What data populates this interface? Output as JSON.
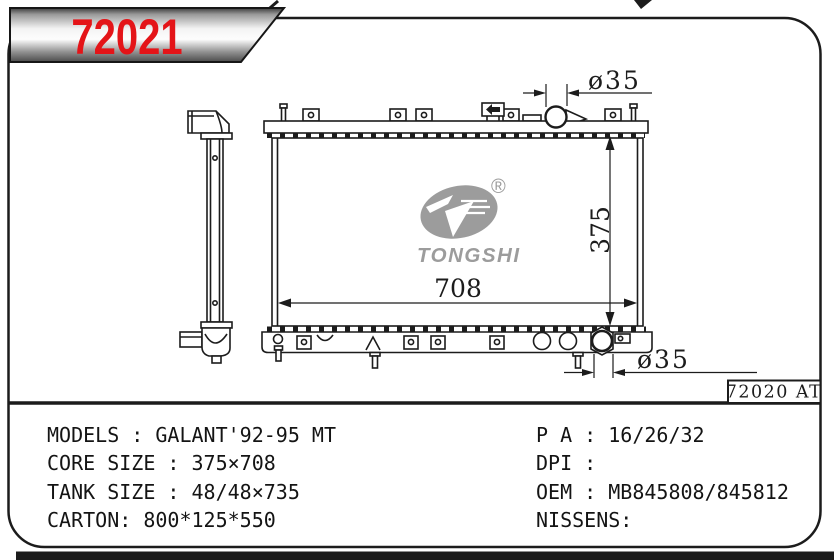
{
  "banner": {
    "part_number": "72021",
    "accent_color": "#e41418"
  },
  "drawing": {
    "inlet_diameter_label": "ø35",
    "core_height_label": "375",
    "core_width_label": "708",
    "outlet_diameter_label": "ø35",
    "ref_label": "72020 AT"
  },
  "logo": {
    "brand": "TONGSHI",
    "registered_mark": "®",
    "color": "#9c9c9c"
  },
  "specs": {
    "left": [
      "MODELS : GALANT'92-95 MT",
      "CORE SIZE : 375×708",
      "TANK SIZE : 48/48×735",
      "CARTON: 800*125*550"
    ],
    "right": [
      "P A : 16/26/32",
      "DPI :",
      "OEM : MB845808/845812",
      "NISSENS:"
    ]
  }
}
